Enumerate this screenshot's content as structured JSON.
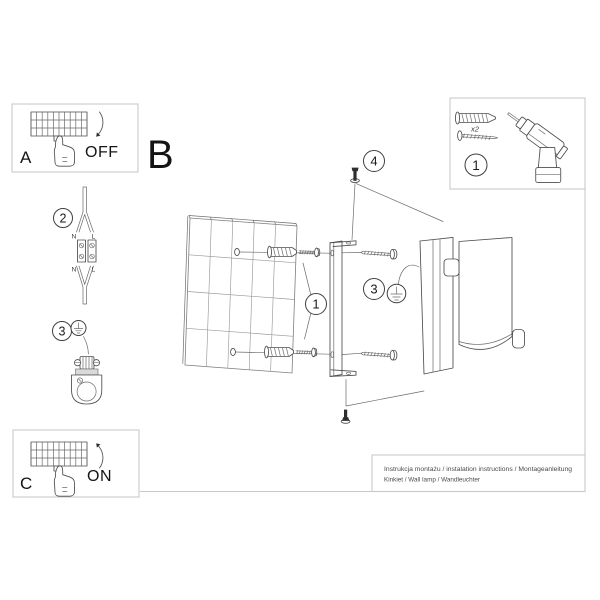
{
  "panel_a": {
    "label": "A",
    "action": "OFF"
  },
  "panel_b": {
    "label": "B"
  },
  "panel_c": {
    "label": "C",
    "action": "ON"
  },
  "toolbox": {
    "step_badge": "1",
    "anchor_quantity": "x2"
  },
  "wiring_step": {
    "badge": "2",
    "neutral": "N",
    "live": "L"
  },
  "ground_step": {
    "badge": "3"
  },
  "main_diagram": {
    "anchor_badge": "1",
    "ground_badge": "3",
    "screw_badge": "4"
  },
  "caption": {
    "line1": "Instrukcja montażu / instalation instructions / Montageanleitung",
    "line2": "Kinkiet / Wall lamp / Wandleuchter"
  },
  "icons": {
    "panel_a": [
      "breaker-panel-icon",
      "pointing-hand-icon",
      "rotate-off-arrow-icon"
    ],
    "panel_c": [
      "breaker-panel-icon",
      "pointing-hand-icon",
      "rotate-on-arrow-icon"
    ],
    "toolbox": [
      "wall-anchor-icon",
      "screw-icon",
      "drill-icon"
    ],
    "steps": [
      "terminal-block-icon",
      "ground-symbol-icon",
      "cable-clamp-icon",
      "tiled-wall",
      "mounting-bracket",
      "wall-lamp-body"
    ]
  },
  "colors": {
    "line": "#4d4d4d",
    "frame_border": "#c9c9c9",
    "background": "#ffffff"
  }
}
